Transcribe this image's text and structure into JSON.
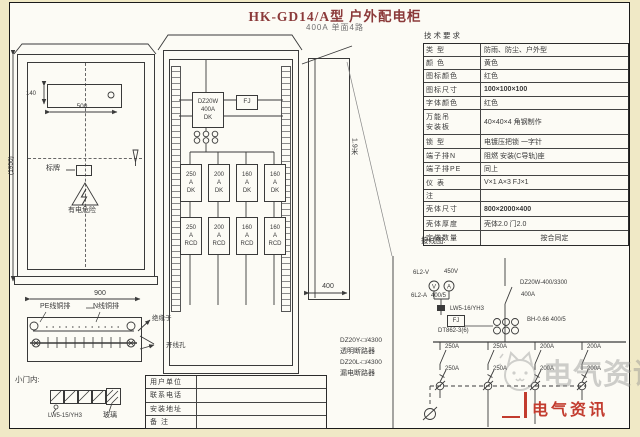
{
  "sheet": {
    "title": "HK-GD14/A型 户外配电柜",
    "subtitle": "400A  单面4路"
  },
  "front_view": {
    "height_dim": "(1950)",
    "door_height_dim": "140",
    "door_width_dim": "500",
    "width_dim": "900",
    "nameplate": "标牌",
    "danger": "有电危险",
    "pe_bar": "PE线铜排",
    "n_bar": "N线铜排",
    "insulator": "绝缘子",
    "wire_hole": "开线孔",
    "door_title": "小门内:",
    "selector_model": "LW5-15/YH3",
    "glass": "玻璃"
  },
  "layout_view": {
    "main": {
      "l1": "DZ20W",
      "l2": "400A",
      "l3": "DK"
    },
    "fj": "FJ",
    "row1": [
      {
        "a": "250",
        "u": "A",
        "t": "DK"
      },
      {
        "a": "200",
        "u": "A",
        "t": "DK"
      },
      {
        "a": "160",
        "u": "A",
        "t": "DK"
      },
      {
        "a": "160",
        "u": "A",
        "t": "DK"
      }
    ],
    "row2": [
      {
        "a": "250",
        "u": "A",
        "t": "RCD"
      },
      {
        "a": "200",
        "u": "A",
        "t": "RCD"
      },
      {
        "a": "160",
        "u": "A",
        "t": "RCD"
      },
      {
        "a": "160",
        "u": "A",
        "t": "RCD"
      }
    ],
    "depth_dim": "400",
    "side_height": "1.9米"
  },
  "tech_table": {
    "title": "技术要求",
    "rows": [
      {
        "label": "类  型",
        "value": "防雨、防尘、户外型"
      },
      {
        "label": "颜  色",
        "value": "黄色"
      },
      {
        "label": "图标颜色",
        "value": "红色"
      },
      {
        "label": "图标尺寸",
        "value": "100×100×100"
      },
      {
        "label": "字体颜色",
        "value": "红色"
      },
      {
        "label": "万能吊",
        "label2": "安装板",
        "value": "40×40×4  角钢制作"
      },
      {
        "label": "锁  型",
        "value": "电镀压把锁 一字针"
      },
      {
        "label": "端子排N",
        "value": "阻燃 安装(C导轨)座"
      },
      {
        "label": "端子排PE",
        "value": "同上"
      },
      {
        "label": "仪  表",
        "value": "V×1  A×3  FJ×1"
      },
      {
        "label": "注",
        "value": ""
      },
      {
        "label": "壳体尺寸",
        "value": "800×2000×400"
      },
      {
        "label": "壳体厚度",
        "value": "壳体2.0  门2.0"
      },
      {
        "label": "定做数量",
        "value": "按合同定"
      }
    ]
  },
  "schematic": {
    "title": "接线图:",
    "voltmeter": "6L2-V",
    "volt_range": "450V",
    "ammeter": "6L2-A",
    "amm_ratio": "400/5",
    "v_sym": "V",
    "a_sym": "A",
    "selector": "LW5-16/YH3",
    "fj": "FJ",
    "energy_meter": "DT862-3(6)",
    "main_model": "DZ20W-400/3300",
    "main_amp": "400A",
    "ct": "BH-0.66 400/5",
    "legend": [
      {
        "model": "DZ20Y-□/4300",
        "name": "透明断路器"
      },
      {
        "model": "DZ20L-□/4300",
        "name": "漏电断路器"
      }
    ],
    "branches": [
      {
        "top": "250A",
        "bottom": "250A"
      },
      {
        "top": "250A",
        "bottom": "250A"
      },
      {
        "top": "200A",
        "bottom": "200A"
      },
      {
        "top": "200A",
        "bottom": "200A"
      }
    ]
  },
  "title_block": {
    "rows": [
      {
        "label": "用户单位",
        "value": ""
      },
      {
        "label": "联系电话",
        "value": ""
      },
      {
        "label": "安装地址",
        "value": ""
      },
      {
        "label": "备  注",
        "value": ""
      }
    ]
  },
  "watermark": {
    "text": "电气资讯",
    "corner": "电气资讯"
  },
  "colors": {
    "accent_red": "#c23b2e",
    "title": "#8b3a3a",
    "line": "#3a3a3a",
    "paper": "#fcfbf5"
  }
}
